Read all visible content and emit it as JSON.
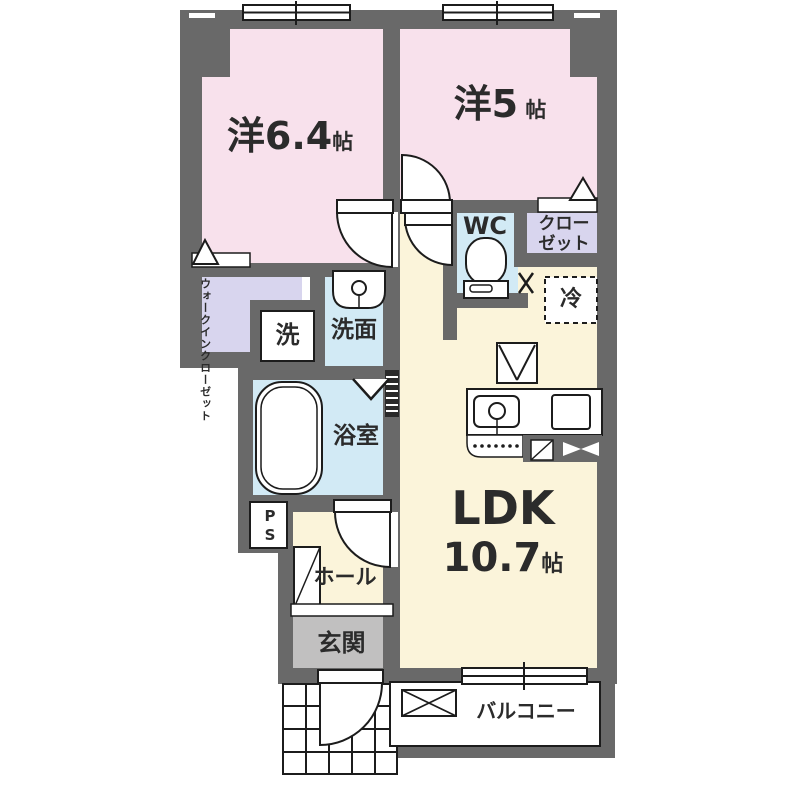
{
  "plan_title": "apartment-floor-plan",
  "colors": {
    "wall": "#696969",
    "bedroom_pink": "#f8e1ec",
    "ldk_cream": "#fbf4da",
    "wet_area_blue": "#d2eaf5",
    "closet_lavender": "#d8d5ee",
    "entrance_gray": "#c1c0c0",
    "outline": "#1c1c1c"
  },
  "rooms": {
    "bedroom1": {
      "name": "洋6.4",
      "unit": "帖"
    },
    "bedroom2": {
      "name": "洋5",
      "unit": "帖"
    },
    "ldk": {
      "name": "LDK",
      "size": "10.7",
      "unit": "帖"
    },
    "wc": {
      "label": "WC"
    },
    "closet": {
      "line1": "クロー",
      "line2": "ゼット"
    },
    "refrigerator": {
      "label": "冷"
    },
    "walk_in_closet": {
      "line1": "ウォークイン",
      "line2": "クローゼット"
    },
    "laundry": {
      "label": "洗"
    },
    "washroom": {
      "label": "洗面"
    },
    "bathroom": {
      "label": "浴室"
    },
    "pipe_space": {
      "label": "PS"
    },
    "hall": {
      "label": "ホール"
    },
    "entrance": {
      "label": "玄関"
    },
    "balcony": {
      "label": "バルコニー"
    }
  }
}
